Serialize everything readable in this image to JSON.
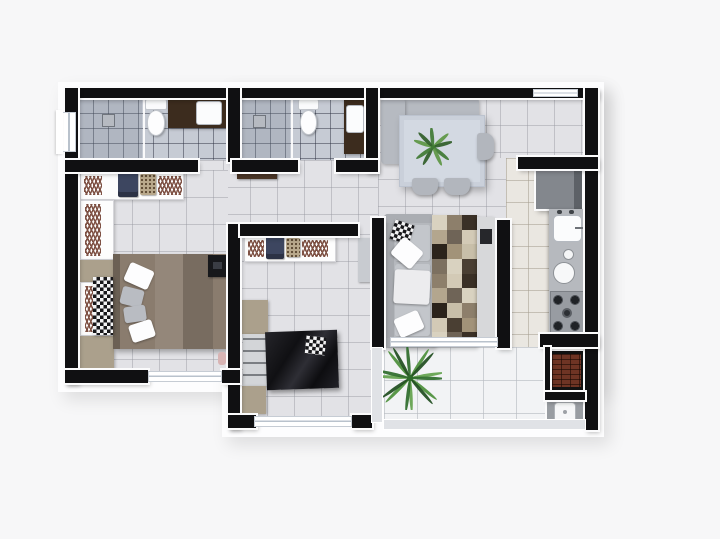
{
  "meta": {
    "kind": "3d-rendered-apartment-floor-plan-top-view",
    "width": 720,
    "height": 539
  },
  "palette": {
    "background": "#f7f7f8",
    "walls": "#101012",
    "wall_trim": "#fbfbfc",
    "tile_floor": "#e2e2e6",
    "bath_floor": "#c6cbd4",
    "kitchen_floor": "#eae7e1",
    "balcony_floor": "#f2f3f5",
    "dark_wood": "#3c2c1e",
    "bed_brown": "#8a7c6e",
    "dark_bed": "#151518",
    "sofa_gray": "#b5b8bd",
    "cabinet_taupe": "#aba08c",
    "brick": "#6e3424",
    "plant_green": "#3f7a33"
  },
  "rooms": [
    {
      "name": "bathroom-1",
      "features": [
        "walk-in-shower",
        "floor-drain",
        "toilet",
        "dark-wood-vanity-with-sink",
        "side-window"
      ]
    },
    {
      "name": "bathroom-2",
      "features": [
        "walk-in-shower",
        "floor-drain",
        "toilet",
        "dark-wood-vanity-with-sink",
        "open-door"
      ]
    },
    {
      "name": "master-bedroom",
      "features": [
        "l-shaped-wardrobe-with-hangers",
        "folded-clothes",
        "double-bed-brown-bedding",
        "checkered-bench",
        "gray-pillows",
        "white-pillows",
        "tv",
        "taupe-dressers",
        "bottom-window"
      ]
    },
    {
      "name": "bedroom-2",
      "features": [
        "wardrobe-with-hangers",
        "folded-clothes",
        "single-bed-dark-bedding",
        "checkered-pillow",
        "taupe-cabinets",
        "desk",
        "open-door",
        "bottom-window"
      ]
    },
    {
      "name": "dining-area",
      "features": [
        "corner-bench",
        "dining-table",
        "plant-centerpiece",
        "two-chairs-south",
        "one-chair-east"
      ]
    },
    {
      "name": "living-room",
      "features": [
        "three-seat-gray-sofa",
        "white-throw-pillows",
        "checkered-pillow",
        "patchwork-rug",
        "tv-panel",
        "glass-opening-to-balcony"
      ]
    },
    {
      "name": "kitchen",
      "features": [
        "refrigerator",
        "counter-with-sink",
        "small-bowls",
        "four-burner-cooktop"
      ]
    },
    {
      "name": "balcony-service-area",
      "features": [
        "potted-palm-plant",
        "brick-barbecue-grill",
        "laundry-tank",
        "glass-railing"
      ]
    }
  ],
  "decor": {
    "rug_cells": [
      "#d9d2c0",
      "#8d7f6b",
      "#3a3026",
      "#b3a68e",
      "#6f6457",
      "#d3cab6",
      "#2b231b",
      "#a29379",
      "#c8bfa9",
      "#7c7060",
      "#d9d2c0",
      "#4a3f33",
      "#8d7f6b",
      "#d3cab6",
      "#3a3026",
      "#b3a68e",
      "#6f6457",
      "#d9d2c0",
      "#2b231b",
      "#c8bfa9",
      "#8d7f6b",
      "#d3cab6",
      "#4a3f33",
      "#a29379",
      "#d9d2c0",
      "#6f6457",
      "#3a3026"
    ],
    "plants": {
      "dining": {
        "leaves": 9,
        "size": 38,
        "leaf_rx": 5,
        "colors": [
          "#3f7a33",
          "#5c9643",
          "#2f5d27"
        ]
      },
      "balcony": {
        "leaves": 15,
        "size": 64,
        "leaf_rx": 2.6,
        "colors": [
          "#2e6b2a",
          "#4c8f3a",
          "#1f4d1e",
          "#63a24c"
        ]
      }
    }
  }
}
